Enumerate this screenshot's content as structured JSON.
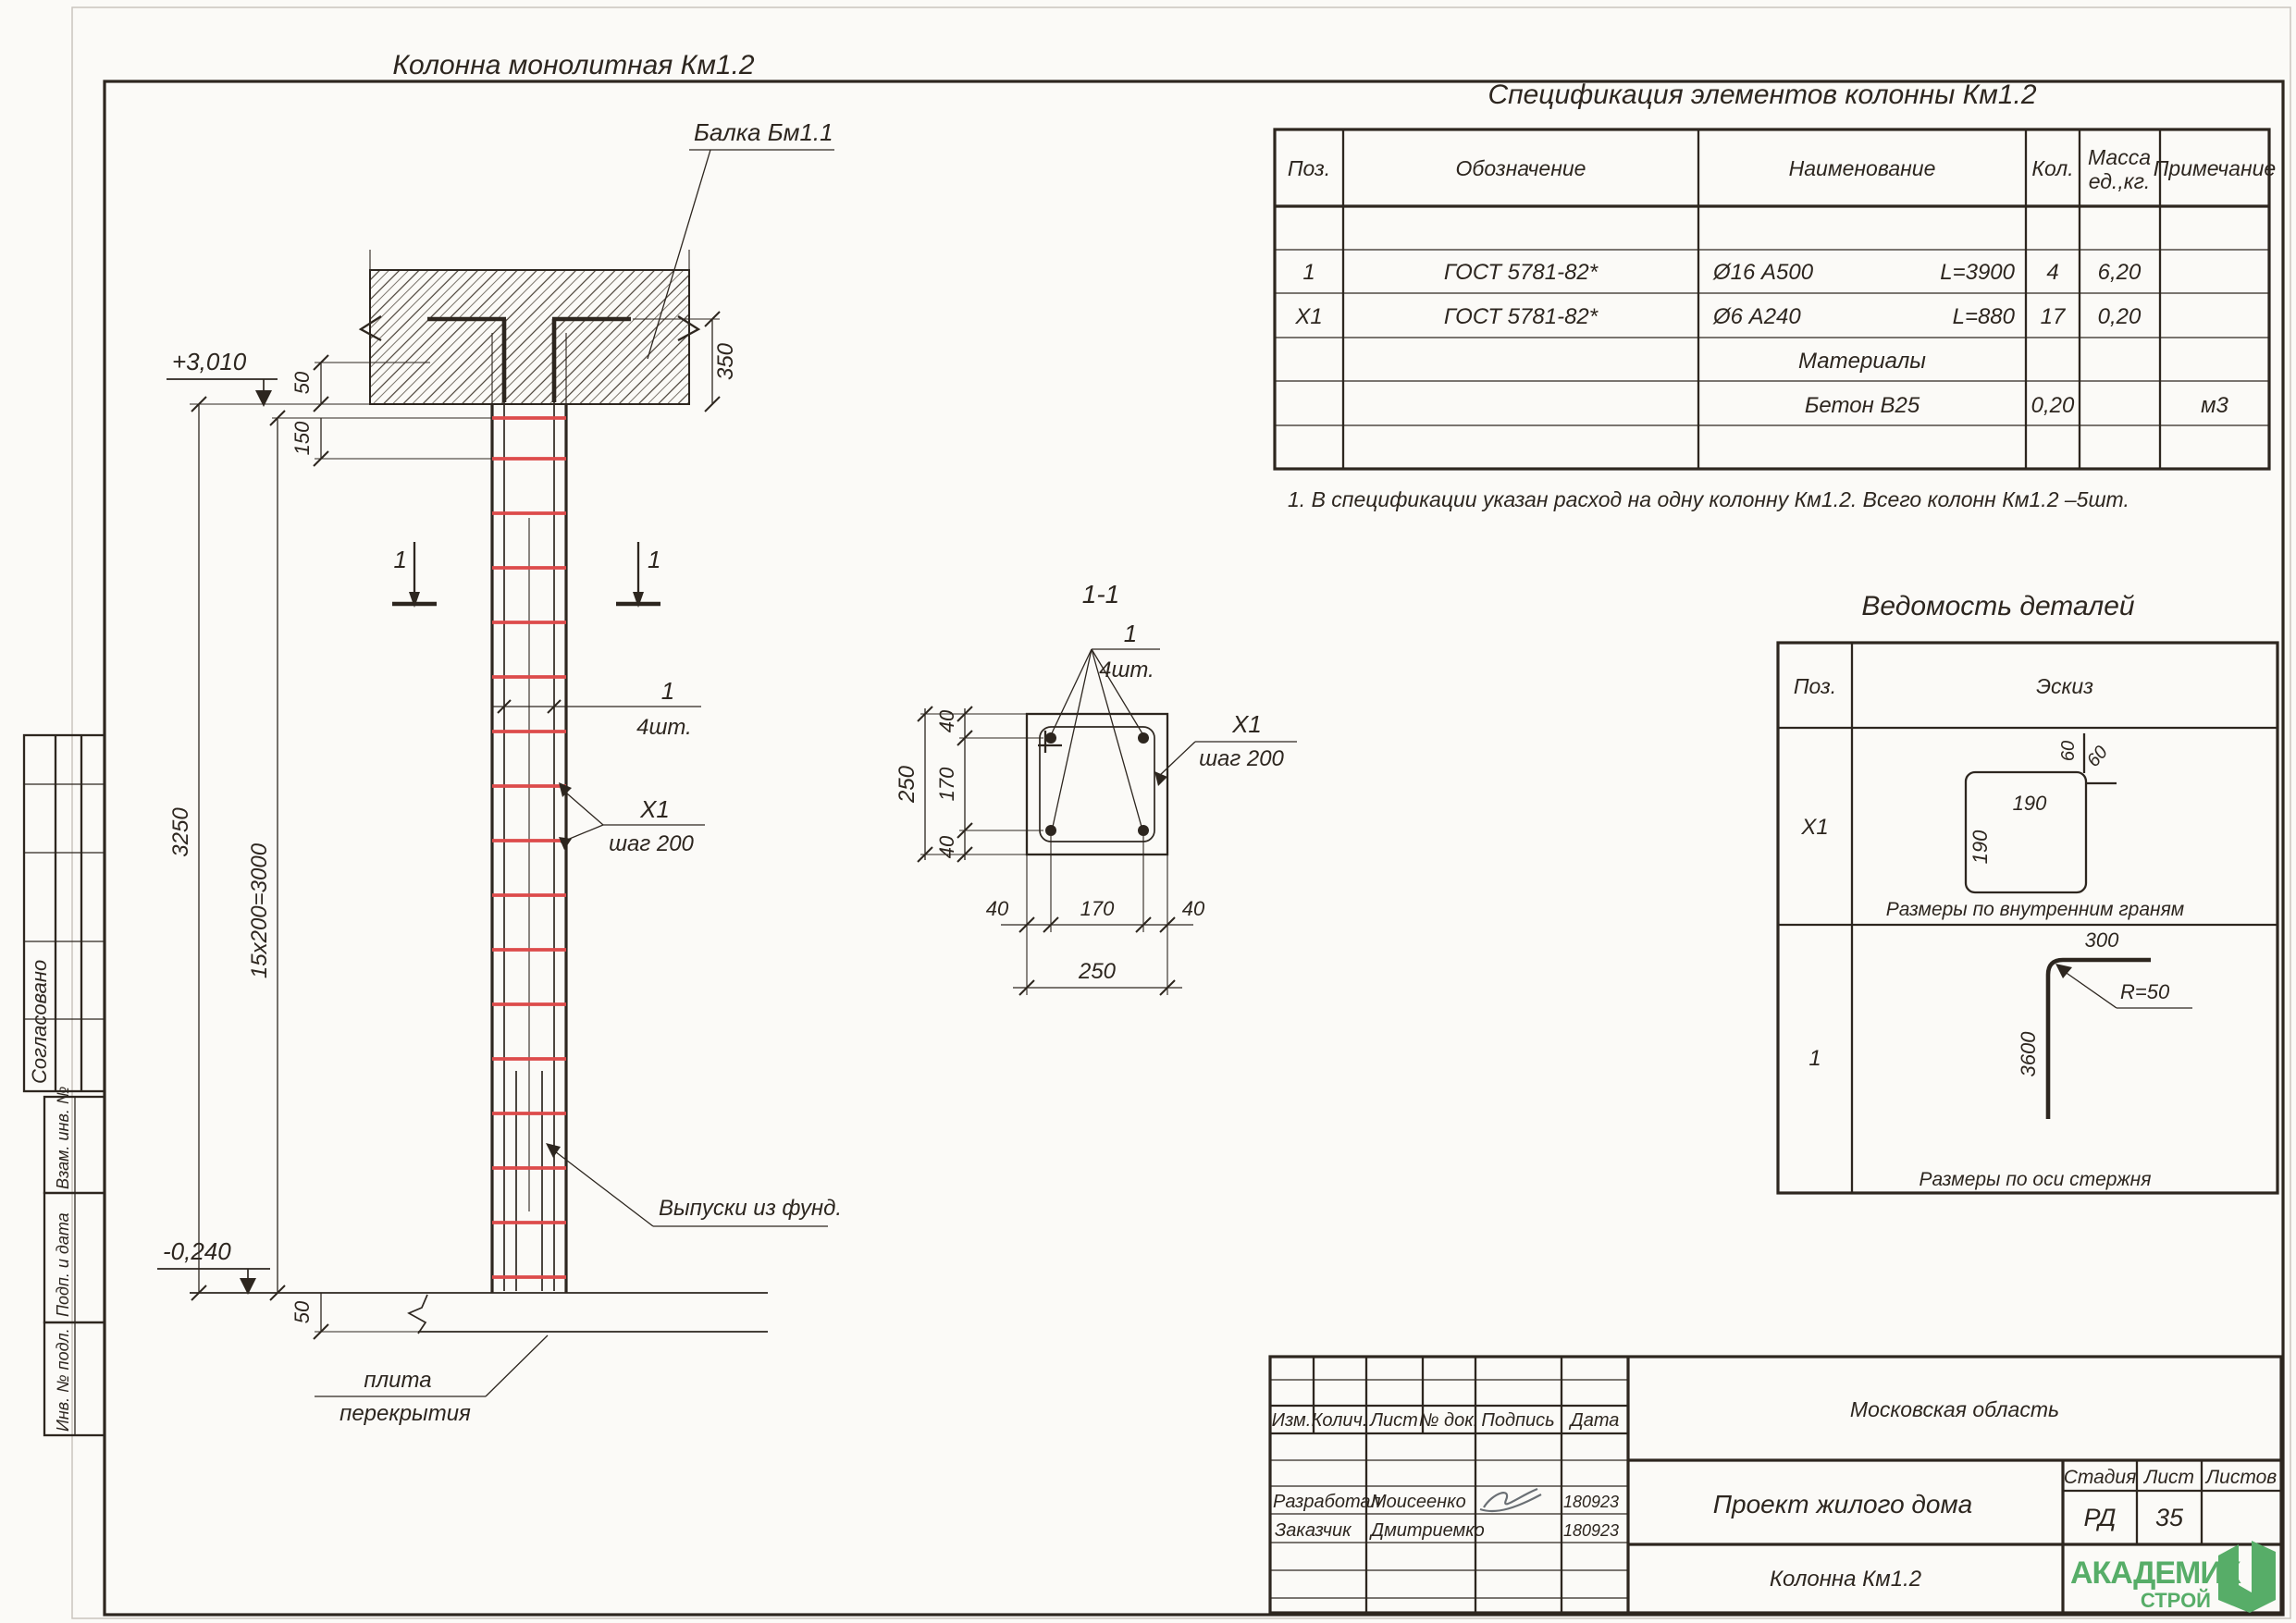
{
  "colors": {
    "line": "#2d261f",
    "stirrup_red": "#dd4b4b",
    "logo_green": "#57ad68",
    "paper": "#fbfaf7"
  },
  "side_strip": {
    "approved": "Согласовано",
    "replace_inv": "Взам. инв. №",
    "sign_date": "Подп. и дата",
    "inv_orig": "Инв. № подл."
  },
  "front_view": {
    "title": "Колонна монолитная Км1.2",
    "beam_label": "Балка Бм1.1",
    "level_top": "+3,010",
    "level_bottom": "-0,240",
    "dim_beam_50": "50",
    "dim_beam_350": "350",
    "dim_150": "150",
    "dim_total": "3250",
    "dim_step": "15x200=3000",
    "dim_bottom_50": "50",
    "section_mark_left": "1",
    "section_mark_right": "1",
    "bar_callout_num": "1",
    "bar_callout_qty": "4шт.",
    "stirrup_callout": "Х1",
    "stirrup_callout_step": "шаг 200",
    "outlets_label": "Выпуски из фунд.",
    "slab_label_line1": "плита",
    "slab_label_line2": "перекрытия"
  },
  "section_view": {
    "title": "1-1",
    "bar_callout_num": "1",
    "bar_callout_qty": "4шт.",
    "stirrup_callout": "Х1",
    "stirrup_callout_step": "шаг 200",
    "dim_v_40_top": "40",
    "dim_v_170": "170",
    "dim_v_40_bot": "40",
    "dim_v_250": "250",
    "dim_h_40_left": "40",
    "dim_h_170": "170",
    "dim_h_40_right": "40",
    "dim_h_250": "250"
  },
  "spec_table": {
    "title": "Спецификация элементов колонны Км1.2",
    "col_pos": "Поз.",
    "col_desig": "Обозначение",
    "col_name": "Наименование",
    "col_qty": "Кол.",
    "col_mass_1": "Масса",
    "col_mass_2": "ед.,кг.",
    "col_note": "Примечание",
    "rows": [
      {
        "pos": "1",
        "desig": "ГОСТ 5781-82*",
        "name": "Ø16 А500",
        "len": "L=3900",
        "qty": "4",
        "mass": "6,20",
        "note": ""
      },
      {
        "pos": "Х1",
        "desig": "ГОСТ 5781-82*",
        "name": "Ø6 А240",
        "len": "L=880",
        "qty": "17",
        "mass": "0,20",
        "note": ""
      },
      {
        "group": "Материалы"
      },
      {
        "name": "Бетон В25",
        "qty": "0,20",
        "note": "м3"
      }
    ],
    "note": "1. В спецификации указан расход на одну колонну Км1.2. Всего колонн Км1.2 –5шт."
  },
  "details_table": {
    "title": "Ведомость деталей",
    "col_pos": "Поз.",
    "col_sketch": "Эскиз",
    "row_x1": {
      "pos": "Х1",
      "dim_w": "190",
      "dim_h": "190",
      "dim_hook_1": "60",
      "dim_hook_2": "60",
      "caption": "Размеры по внутренним граням"
    },
    "row_1": {
      "pos": "1",
      "dim_top": "300",
      "dim_r": "R=50",
      "dim_len": "3600",
      "caption": "Размеры по оси стержня"
    }
  },
  "title_block": {
    "cols": {
      "izm": "Изм.",
      "kol": "Колич.",
      "list": "Лист",
      "doc": "№ док.",
      "sign": "Подпись",
      "date": "Дата"
    },
    "region": "Московская область",
    "project": "Проект жилого дома",
    "object": "Колонна Км1.2",
    "stage_label": "Стадия",
    "list_label": "Лист",
    "listov_label": "Листов",
    "stage": "РД",
    "sheet": "35",
    "row_dev_role": "Разработал",
    "row_dev_name": "Моисеенко",
    "row_dev_date": "180923",
    "row_cust_role": "Заказчик",
    "row_cust_name": "Дмитриемко",
    "row_cust_date": "180923",
    "logo_top": "АКАДЕМИК",
    "logo_bottom": "СТРОЙ"
  }
}
